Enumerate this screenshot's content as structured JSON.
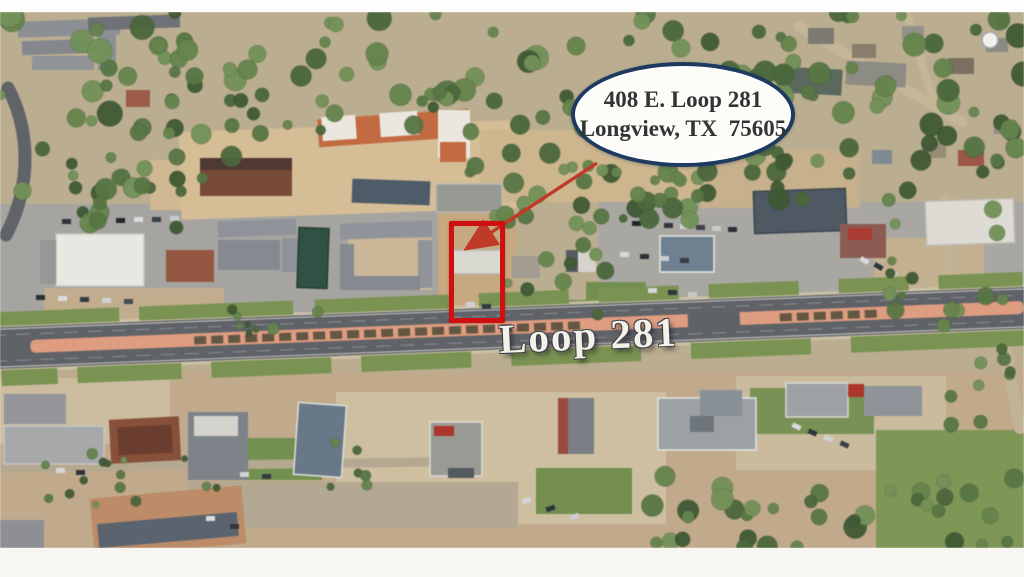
{
  "callout": {
    "line1": "408 E. Loop 281",
    "line2": "Longview, TX  75605"
  },
  "road_label": {
    "text": "Loop 281"
  },
  "theme": {
    "pageBg": "#fdfdfc",
    "navy": "#1e3a5f",
    "calloutFill": "#fcfcf9",
    "calloutText": "#333333",
    "red": "#ce1010",
    "arrow": "#c03a28",
    "labelColor": "#f4f1e8",
    "photoBase": "#bcae8e"
  },
  "arrow": {
    "from": [
      597,
      163
    ],
    "to": [
      469,
      247
    ]
  },
  "scene": {
    "base": {
      "x": 0,
      "y": 12,
      "w": 1024,
      "h": 536,
      "c": "#bcae8e"
    },
    "areas": [
      {
        "x": 0,
        "y": 204,
        "w": 452,
        "h": 134,
        "c": "#a5a4a0"
      },
      {
        "x": 598,
        "y": 202,
        "w": 426,
        "h": 118,
        "c": "#a9a7a2"
      },
      {
        "x": 348,
        "y": 238,
        "w": 84,
        "h": 52,
        "c": "#ccb795"
      },
      {
        "x": 44,
        "y": 288,
        "w": 180,
        "h": 42,
        "c": "#c2ad8a"
      },
      {
        "x": 150,
        "y": 160,
        "w": 90,
        "h": 50,
        "c": "#d2b98f"
      },
      {
        "x": 180,
        "y": 126,
        "w": 340,
        "h": 88,
        "c": "#d7bd93",
        "rot": -2
      },
      {
        "x": 480,
        "y": 130,
        "w": 230,
        "h": 72,
        "c": "#cfb68b"
      },
      {
        "x": 700,
        "y": 150,
        "w": 160,
        "h": 58,
        "c": "#c9b189"
      },
      {
        "x": 438,
        "y": 210,
        "w": 78,
        "h": 128,
        "c": "#c9a97e"
      },
      {
        "x": 874,
        "y": 238,
        "w": 110,
        "h": 66,
        "c": "#c3b08d"
      },
      {
        "x": 0,
        "y": 372,
        "w": 1024,
        "h": 176,
        "c": "#c1aa88"
      },
      {
        "x": 0,
        "y": 378,
        "w": 170,
        "h": 66,
        "c": "#cdbc9d"
      },
      {
        "x": 336,
        "y": 392,
        "w": 330,
        "h": 132,
        "c": "#cfbf9f"
      },
      {
        "x": 736,
        "y": 376,
        "w": 210,
        "h": 94,
        "c": "#cbbb9c"
      },
      {
        "x": 188,
        "y": 482,
        "w": 330,
        "h": 46,
        "c": "#b4a88f"
      },
      {
        "x": 876,
        "y": 430,
        "w": 148,
        "h": 118,
        "c": "#7d9752"
      },
      {
        "x": 750,
        "y": 388,
        "w": 124,
        "h": 46,
        "c": "#789250"
      },
      {
        "x": 536,
        "y": 468,
        "w": 96,
        "h": 46,
        "c": "#738f4c"
      },
      {
        "x": 246,
        "y": 438,
        "w": 76,
        "h": 42,
        "c": "#71914b"
      },
      {
        "x": 516,
        "y": 300,
        "w": 90,
        "h": 36,
        "c": "#6f8d49"
      },
      {
        "x": 586,
        "y": 282,
        "w": 60,
        "h": 40,
        "c": "#72904b"
      }
    ],
    "streets": [
      {
        "d": "M 8,88 C 30,130 32,185 6,235",
        "c": "#606368",
        "w": 13
      },
      {
        "d": "M 798,26 L 962,122",
        "c": "#c5b695",
        "w": 10
      },
      {
        "d": "M 906,12 L 942,128",
        "c": "#c5b695",
        "w": 8
      },
      {
        "d": "M 946,198 L 950,308",
        "c": "#c3b394",
        "w": 10
      },
      {
        "d": "M 1002,332 L 1020,428",
        "c": "#c3b394",
        "w": 12
      },
      {
        "d": "M 0,468 L 430,462",
        "c": "#b5a88f",
        "w": 9
      }
    ],
    "road": {
      "cx": 512,
      "cy": 328,
      "angle": -2.25,
      "len": 1040,
      "half": 21,
      "asphalt": "#5f6267",
      "edgeLine": "#d4d4cc",
      "laneLine": "#9fa3a8",
      "sidewalk": "#d0c4a8",
      "medianColor": "#e29b7d",
      "medianX": [
        -482,
        512
      ],
      "dashColor": "#57503c",
      "dashRanges": [
        [
          -318,
          76
        ],
        [
          268,
          370
        ]
      ],
      "crossover": [
        176,
        52
      ],
      "lawnColor": "#79934e",
      "lawnN": [
        [
          -512,
          -392
        ],
        [
          -372,
          -218
        ],
        [
          -196,
          -62
        ],
        [
          -32,
          58
        ],
        [
          88,
          168
        ],
        [
          198,
          288
        ],
        [
          328,
          398
        ],
        [
          428,
          512
        ]
      ],
      "lawnS": [
        [
          -512,
          -456
        ],
        [
          -436,
          -332
        ],
        [
          -302,
          -182
        ],
        [
          -152,
          -42
        ],
        [
          -2,
          128
        ],
        [
          178,
          298
        ],
        [
          338,
          512
        ]
      ]
    },
    "buildings": [
      {
        "x": 18,
        "y": 20,
        "w": 102,
        "h": 16,
        "rot": -2,
        "c": "#8c8f94"
      },
      {
        "x": 22,
        "y": 40,
        "w": 72,
        "h": 14,
        "rot": -2,
        "c": "#84878c"
      },
      {
        "x": 98,
        "y": 30,
        "w": 18,
        "h": 40,
        "c": "#8c8f94"
      },
      {
        "x": 32,
        "y": 56,
        "w": 62,
        "h": 14,
        "c": "#909398"
      },
      {
        "x": 88,
        "y": 16,
        "w": 92,
        "h": 13,
        "rot": -2,
        "c": "#6e7176"
      },
      {
        "x": 126,
        "y": 90,
        "w": 24,
        "h": 17,
        "c": "#a05a44"
      },
      {
        "x": 200,
        "y": 158,
        "w": 92,
        "h": 38,
        "c": "#7b4a37"
      },
      {
        "x": 200,
        "y": 158,
        "w": 92,
        "h": 12,
        "c": "#503931"
      },
      {
        "x": 352,
        "y": 180,
        "w": 78,
        "h": 24,
        "rot": 2,
        "c": "#4d5c6a"
      },
      {
        "x": 318,
        "y": 114,
        "w": 152,
        "h": 28,
        "rot": -4,
        "c": "#c76a3e"
      },
      {
        "x": 322,
        "y": 116,
        "w": 34,
        "h": 24,
        "rot": -4,
        "c": "#ebe7de"
      },
      {
        "x": 380,
        "y": 112,
        "w": 38,
        "h": 24,
        "rot": -4,
        "c": "#ebe7de"
      },
      {
        "x": 438,
        "y": 110,
        "w": 32,
        "h": 48,
        "c": "#ebe7de"
      },
      {
        "x": 440,
        "y": 142,
        "w": 26,
        "h": 20,
        "c": "#c76a3e"
      },
      {
        "x": 56,
        "y": 234,
        "w": 88,
        "h": 52,
        "c": "#e8e7e2",
        "s": "#c8c7c1"
      },
      {
        "x": 40,
        "y": 240,
        "w": 16,
        "h": 44,
        "c": "#979797"
      },
      {
        "x": 166,
        "y": 250,
        "w": 48,
        "h": 32,
        "c": "#9a5640"
      },
      {
        "x": 218,
        "y": 220,
        "w": 78,
        "h": 16,
        "rot": -2,
        "c": "#8f939a"
      },
      {
        "x": 218,
        "y": 240,
        "w": 62,
        "h": 30,
        "c": "#868a91"
      },
      {
        "x": 282,
        "y": 238,
        "w": 16,
        "h": 34,
        "c": "#8f939a"
      },
      {
        "x": 298,
        "y": 228,
        "w": 30,
        "h": 60,
        "rot": 2,
        "c": "#2f5244",
        "s": "#223d33"
      },
      {
        "x": 340,
        "y": 222,
        "w": 92,
        "h": 16,
        "rot": -2,
        "c": "#90949b"
      },
      {
        "x": 340,
        "y": 244,
        "w": 14,
        "h": 46,
        "c": "#868a91"
      },
      {
        "x": 418,
        "y": 240,
        "w": 14,
        "h": 48,
        "c": "#90949b"
      },
      {
        "x": 352,
        "y": 276,
        "w": 68,
        "h": 14,
        "c": "#868a91"
      },
      {
        "x": 436,
        "y": 184,
        "w": 66,
        "h": 28,
        "c": "#999993",
        "s": "#b9b9b2"
      },
      {
        "x": 452,
        "y": 250,
        "w": 50,
        "h": 24,
        "c": "#d8d7d0",
        "s": "#b5b3aa"
      },
      {
        "x": 512,
        "y": 256,
        "w": 28,
        "h": 22,
        "c": "#a19b91"
      },
      {
        "x": 566,
        "y": 250,
        "w": 30,
        "h": 22,
        "c": "#d5d3cb"
      },
      {
        "x": 566,
        "y": 250,
        "w": 12,
        "h": 22,
        "c": "#565b63"
      },
      {
        "x": 660,
        "y": 236,
        "w": 54,
        "h": 36,
        "c": "#6e8191",
        "s": "#e7e7e2"
      },
      {
        "x": 754,
        "y": 190,
        "w": 92,
        "h": 42,
        "rot": -2,
        "c": "#4e5965",
        "s": "#39434e"
      },
      {
        "x": 840,
        "y": 224,
        "w": 46,
        "h": 34,
        "c": "#8e5b51"
      },
      {
        "x": 848,
        "y": 228,
        "w": 24,
        "h": 12,
        "c": "#b23a2e"
      },
      {
        "x": 926,
        "y": 200,
        "w": 88,
        "h": 44,
        "rot": -2,
        "c": "#dddbd4",
        "s": "#c1bfb7"
      },
      {
        "x": 778,
        "y": 68,
        "w": 64,
        "h": 26,
        "rot": 3,
        "c": "#5a685c"
      },
      {
        "x": 846,
        "y": 62,
        "w": 60,
        "h": 24,
        "rot": 3,
        "c": "#8c8c84"
      },
      {
        "x": 808,
        "y": 28,
        "w": 26,
        "h": 16,
        "c": "#7d7a72"
      },
      {
        "x": 852,
        "y": 44,
        "w": 24,
        "h": 14,
        "c": "#8a7e6c"
      },
      {
        "x": 902,
        "y": 26,
        "w": 22,
        "h": 14,
        "c": "#94908a"
      },
      {
        "x": 948,
        "y": 58,
        "w": 26,
        "h": 16,
        "c": "#7b6f60"
      },
      {
        "x": 986,
        "y": 38,
        "w": 22,
        "h": 14,
        "c": "#8a8a82"
      },
      {
        "x": 922,
        "y": 142,
        "w": 24,
        "h": 16,
        "c": "#988c74"
      },
      {
        "x": 958,
        "y": 150,
        "w": 26,
        "h": 16,
        "c": "#a05544"
      },
      {
        "x": 994,
        "y": 120,
        "w": 22,
        "h": 14,
        "c": "#8d8d84"
      },
      {
        "x": 872,
        "y": 150,
        "w": 20,
        "h": 14,
        "c": "#7f8b92"
      },
      {
        "x": 4,
        "y": 394,
        "w": 62,
        "h": 30,
        "c": "#94969a"
      },
      {
        "x": 4,
        "y": 426,
        "w": 100,
        "h": 38,
        "c": "#a7a8aa",
        "s": "#c6c6c2"
      },
      {
        "x": 110,
        "y": 418,
        "w": 70,
        "h": 44,
        "rot": -3,
        "c": "#8a4f38"
      },
      {
        "x": 118,
        "y": 426,
        "w": 54,
        "h": 28,
        "rot": -3,
        "c": "#6e3c2c"
      },
      {
        "x": 188,
        "y": 412,
        "w": 60,
        "h": 68,
        "c": "#7e828a"
      },
      {
        "x": 194,
        "y": 416,
        "w": 44,
        "h": 20,
        "c": "#d4d3ce"
      },
      {
        "x": 296,
        "y": 404,
        "w": 48,
        "h": 72,
        "rot": 4,
        "c": "#68788a",
        "s": "#dde0da"
      },
      {
        "x": 430,
        "y": 422,
        "w": 52,
        "h": 54,
        "c": "#9a9a95",
        "s": "#dcdcd6"
      },
      {
        "x": 434,
        "y": 426,
        "w": 20,
        "h": 10,
        "c": "#b23427"
      },
      {
        "x": 448,
        "y": 468,
        "w": 26,
        "h": 10,
        "c": "#555a61"
      },
      {
        "x": 558,
        "y": 398,
        "w": 36,
        "h": 56,
        "c": "#7b7f86"
      },
      {
        "x": 558,
        "y": 398,
        "w": 10,
        "h": 56,
        "c": "#9e4a3c"
      },
      {
        "x": 658,
        "y": 398,
        "w": 98,
        "h": 52,
        "c": "#9ba1a4",
        "s": "#e4e4df"
      },
      {
        "x": 700,
        "y": 390,
        "w": 42,
        "h": 26,
        "c": "#899095"
      },
      {
        "x": 690,
        "y": 416,
        "w": 24,
        "h": 16,
        "c": "#6d747b"
      },
      {
        "x": 786,
        "y": 383,
        "w": 62,
        "h": 34,
        "c": "#9ea2a5",
        "s": "#d8d8d2"
      },
      {
        "x": 848,
        "y": 384,
        "w": 16,
        "h": 13,
        "c": "#b23427"
      },
      {
        "x": 864,
        "y": 386,
        "w": 58,
        "h": 30,
        "c": "#8e9499"
      },
      {
        "x": 92,
        "y": 492,
        "w": 152,
        "h": 58,
        "rot": -5,
        "c": "#bf8a64"
      },
      {
        "x": 98,
        "y": 518,
        "w": 140,
        "h": 24,
        "rot": -5,
        "c": "#59636f"
      },
      {
        "x": 0,
        "y": 520,
        "w": 44,
        "h": 30,
        "c": "#8d8f93"
      }
    ],
    "cars": [
      {
        "x": 62,
        "y": 219,
        "c": "#2f353c"
      },
      {
        "x": 80,
        "y": 219,
        "c": "#dfe1e3"
      },
      {
        "x": 98,
        "y": 218,
        "c": "#7a818a"
      },
      {
        "x": 116,
        "y": 218,
        "c": "#22272e"
      },
      {
        "x": 134,
        "y": 217,
        "c": "#d8dadc"
      },
      {
        "x": 152,
        "y": 217,
        "c": "#3a4048"
      },
      {
        "x": 170,
        "y": 216,
        "c": "#c9ccce"
      },
      {
        "x": 36,
        "y": 295,
        "c": "#2b3036"
      },
      {
        "x": 58,
        "y": 296,
        "c": "#d9dbdd"
      },
      {
        "x": 80,
        "y": 297,
        "c": "#343a42"
      },
      {
        "x": 102,
        "y": 298,
        "c": "#cfd2d4"
      },
      {
        "x": 124,
        "y": 299,
        "c": "#454b52"
      },
      {
        "x": 632,
        "y": 221,
        "c": "#23282f"
      },
      {
        "x": 648,
        "y": 222,
        "c": "#dadcde"
      },
      {
        "x": 664,
        "y": 223,
        "c": "#30363d"
      },
      {
        "x": 680,
        "y": 224,
        "c": "#d2d4d6"
      },
      {
        "x": 696,
        "y": 225,
        "c": "#3d434a"
      },
      {
        "x": 712,
        "y": 226,
        "c": "#c8cacc"
      },
      {
        "x": 728,
        "y": 227,
        "c": "#2a3037"
      },
      {
        "x": 620,
        "y": 252,
        "c": "#d7d9db"
      },
      {
        "x": 640,
        "y": 254,
        "c": "#2c3239"
      },
      {
        "x": 660,
        "y": 256,
        "c": "#c9ccce"
      },
      {
        "x": 680,
        "y": 258,
        "c": "#363c43"
      },
      {
        "x": 648,
        "y": 288,
        "c": "#d3d5d7"
      },
      {
        "x": 668,
        "y": 290,
        "c": "#2e343b"
      },
      {
        "x": 688,
        "y": 292,
        "c": "#c6c9cb"
      },
      {
        "x": 860,
        "y": 258,
        "c": "#d8dadc",
        "rot": 30
      },
      {
        "x": 874,
        "y": 264,
        "c": "#2f353c",
        "rot": 30
      },
      {
        "x": 888,
        "y": 270,
        "c": "#ccced0",
        "rot": 30
      },
      {
        "x": 466,
        "y": 302,
        "c": "#cdd0d4"
      },
      {
        "x": 482,
        "y": 304,
        "c": "#343b44"
      },
      {
        "x": 56,
        "y": 468,
        "c": "#d6d8da"
      },
      {
        "x": 76,
        "y": 470,
        "c": "#2e343b"
      },
      {
        "x": 240,
        "y": 472,
        "c": "#d2d4d6"
      },
      {
        "x": 262,
        "y": 474,
        "c": "#363c43"
      },
      {
        "x": 522,
        "y": 498,
        "c": "#d5d7d9",
        "rot": -20
      },
      {
        "x": 546,
        "y": 506,
        "c": "#2d333a",
        "rot": -20
      },
      {
        "x": 570,
        "y": 514,
        "c": "#cbced0",
        "rot": -20
      },
      {
        "x": 792,
        "y": 424,
        "c": "#d7d9db",
        "rot": 25
      },
      {
        "x": 808,
        "y": 430,
        "c": "#30363d",
        "rot": 25
      },
      {
        "x": 824,
        "y": 436,
        "c": "#cfd1d3",
        "rot": 25
      },
      {
        "x": 840,
        "y": 442,
        "c": "#3a4047",
        "rot": 25
      },
      {
        "x": 206,
        "y": 516,
        "c": "#dadcde"
      },
      {
        "x": 230,
        "y": 524,
        "c": "#31373e"
      }
    ],
    "tree_palette": [
      "#3e5a32",
      "#4a6839",
      "#577741",
      "#648549",
      "#719255"
    ],
    "tree_clusters": [
      {
        "x": 0,
        "y": 12,
        "w": 1024,
        "h": 116,
        "n": 115,
        "seed": 7,
        "rmin": 5,
        "rmax": 13
      },
      {
        "x": 0,
        "y": 118,
        "w": 238,
        "h": 112,
        "n": 30,
        "seed": 11,
        "rmin": 5,
        "rmax": 11
      },
      {
        "x": 238,
        "y": 92,
        "w": 260,
        "h": 42,
        "n": 16,
        "seed": 23,
        "rmin": 4,
        "rmax": 9
      },
      {
        "x": 468,
        "y": 138,
        "w": 250,
        "h": 84,
        "n": 26,
        "seed": 31,
        "rmin": 5,
        "rmax": 11
      },
      {
        "x": 688,
        "y": 92,
        "w": 336,
        "h": 112,
        "n": 34,
        "seed": 41,
        "rmin": 5,
        "rmax": 11
      },
      {
        "x": 880,
        "y": 198,
        "w": 144,
        "h": 118,
        "n": 14,
        "seed": 53,
        "rmin": 4,
        "rmax": 9
      },
      {
        "x": 504,
        "y": 198,
        "w": 108,
        "h": 118,
        "n": 14,
        "seed": 61,
        "rmin": 4,
        "rmax": 9
      },
      {
        "x": 610,
        "y": 172,
        "w": 92,
        "h": 52,
        "n": 8,
        "seed": 71,
        "rmin": 4,
        "rmax": 8
      },
      {
        "x": 636,
        "y": 474,
        "w": 260,
        "h": 74,
        "n": 24,
        "seed": 83,
        "rmin": 5,
        "rmax": 12
      },
      {
        "x": 898,
        "y": 478,
        "w": 126,
        "h": 68,
        "n": 12,
        "seed": 97,
        "rmin": 5,
        "rmax": 10
      },
      {
        "x": 40,
        "y": 450,
        "w": 195,
        "h": 58,
        "n": 15,
        "seed": 103,
        "rmin": 3,
        "rmax": 6
      },
      {
        "x": 298,
        "y": 436,
        "w": 84,
        "h": 52,
        "n": 6,
        "seed": 113,
        "rmin": 3,
        "rmax": 6
      },
      {
        "x": 928,
        "y": 298,
        "w": 96,
        "h": 128,
        "n": 10,
        "seed": 127,
        "rmin": 4,
        "rmax": 8
      },
      {
        "x": 226,
        "y": 298,
        "w": 120,
        "h": 36,
        "n": 8,
        "seed": 131,
        "rmin": 3,
        "rmax": 7
      }
    ],
    "artifact": {
      "x": 990,
      "y": 40,
      "r": 8,
      "c": "#f2f1ee",
      "s": "#9aa4ad"
    }
  }
}
